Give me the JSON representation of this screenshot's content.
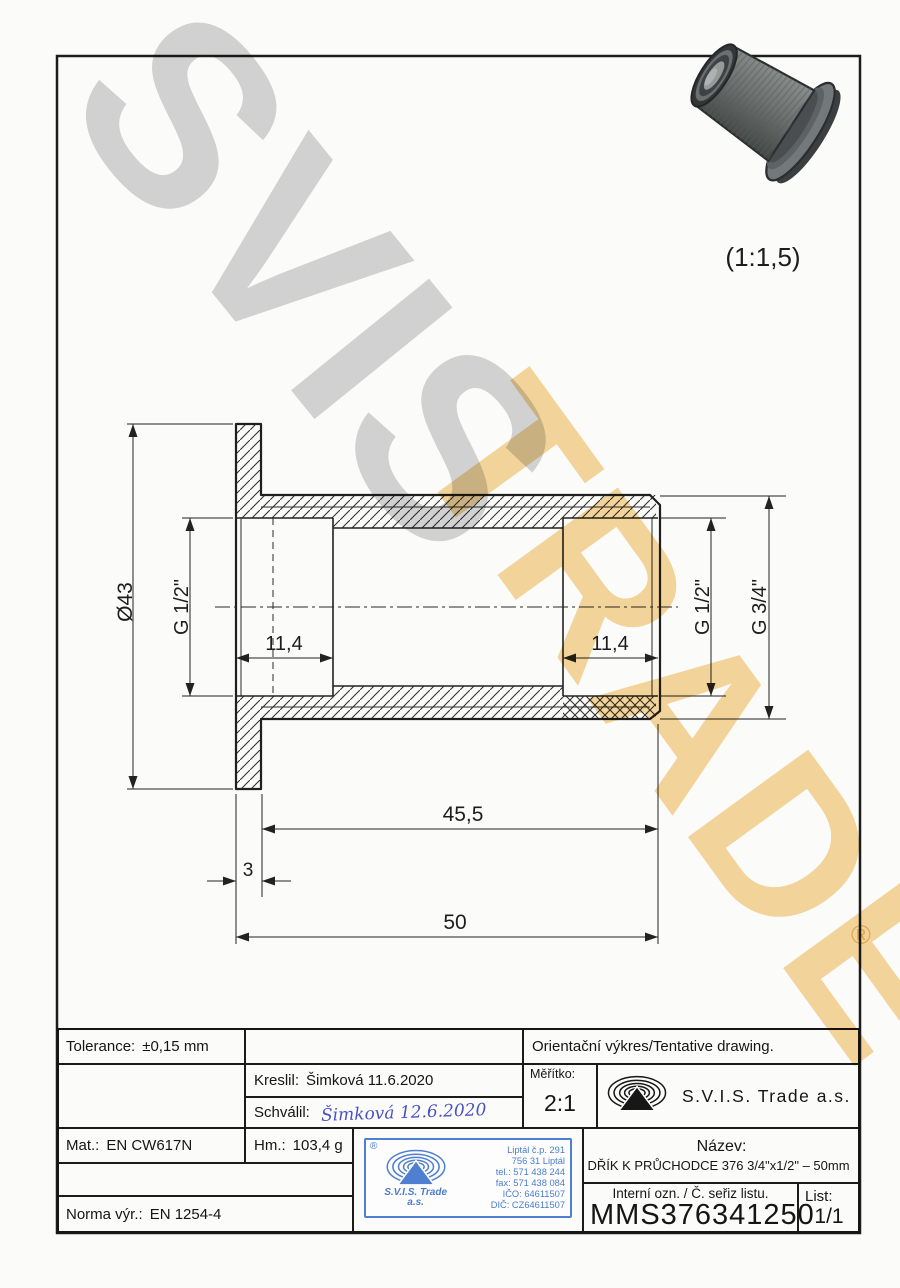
{
  "watermark": {
    "word1": "SVIS",
    "word2": "TRADE",
    "registered_mark": "®",
    "gray": "#d5d5d5",
    "orange": "#f6d79c"
  },
  "preview": {
    "scale_note": "(1:1,5)"
  },
  "drawing": {
    "dims": {
      "flange_diameter": "Ø43",
      "thread_left": "G 1/2\"",
      "thread_depth_left": "11,4",
      "thread_depth_right": "11,4",
      "thread_right": "G 1/2\"",
      "thread_outer": "G 3/4\"",
      "body_length": "45,5",
      "flange_thickness": "3",
      "total_length": "50"
    }
  },
  "title_block": {
    "tolerance_label": "Tolerance:",
    "tolerance_value": "±0,15 mm",
    "orientation_note": "Orientační výkres/Tentative drawing.",
    "drawn_label": "Kreslil:",
    "drawn_value": "Šimková 11.6.2020",
    "approved_label": "Schválil:",
    "approved_value": "Šimková 12.6.2020",
    "scale_label": "Měřítko:",
    "scale_value": "2:1",
    "company_name": "S.V.I.S. Trade a.s.",
    "material_label": "Mat.:",
    "material_value": "EN CW617N",
    "mass_label": "Hm.:",
    "mass_value": "103,4 g",
    "norm_label": "Norma výr.:",
    "norm_value": "EN 1254-4",
    "name_label": "Název:",
    "name_value": "DŘÍK K PRŮCHODCE 376 3/4\"x1/2\" – 50mm",
    "internal_label": "Interní ozn. / Č. seřiz listu.",
    "internal_value": "MMS376341250",
    "sheet_label": "List:",
    "sheet_value": "1/1"
  },
  "stamp": {
    "registered_mark": "®",
    "company_line1": "S.V.I.S. Trade",
    "company_line2": "a.s.",
    "address": [
      "Liptál č.p. 291",
      "756 31 Liptál",
      "tel.: 571 438 244",
      "fax: 571 438 084",
      "IČO: 64611507",
      "DIČ: CZ64611507"
    ],
    "blue": "#4f7fd0"
  }
}
